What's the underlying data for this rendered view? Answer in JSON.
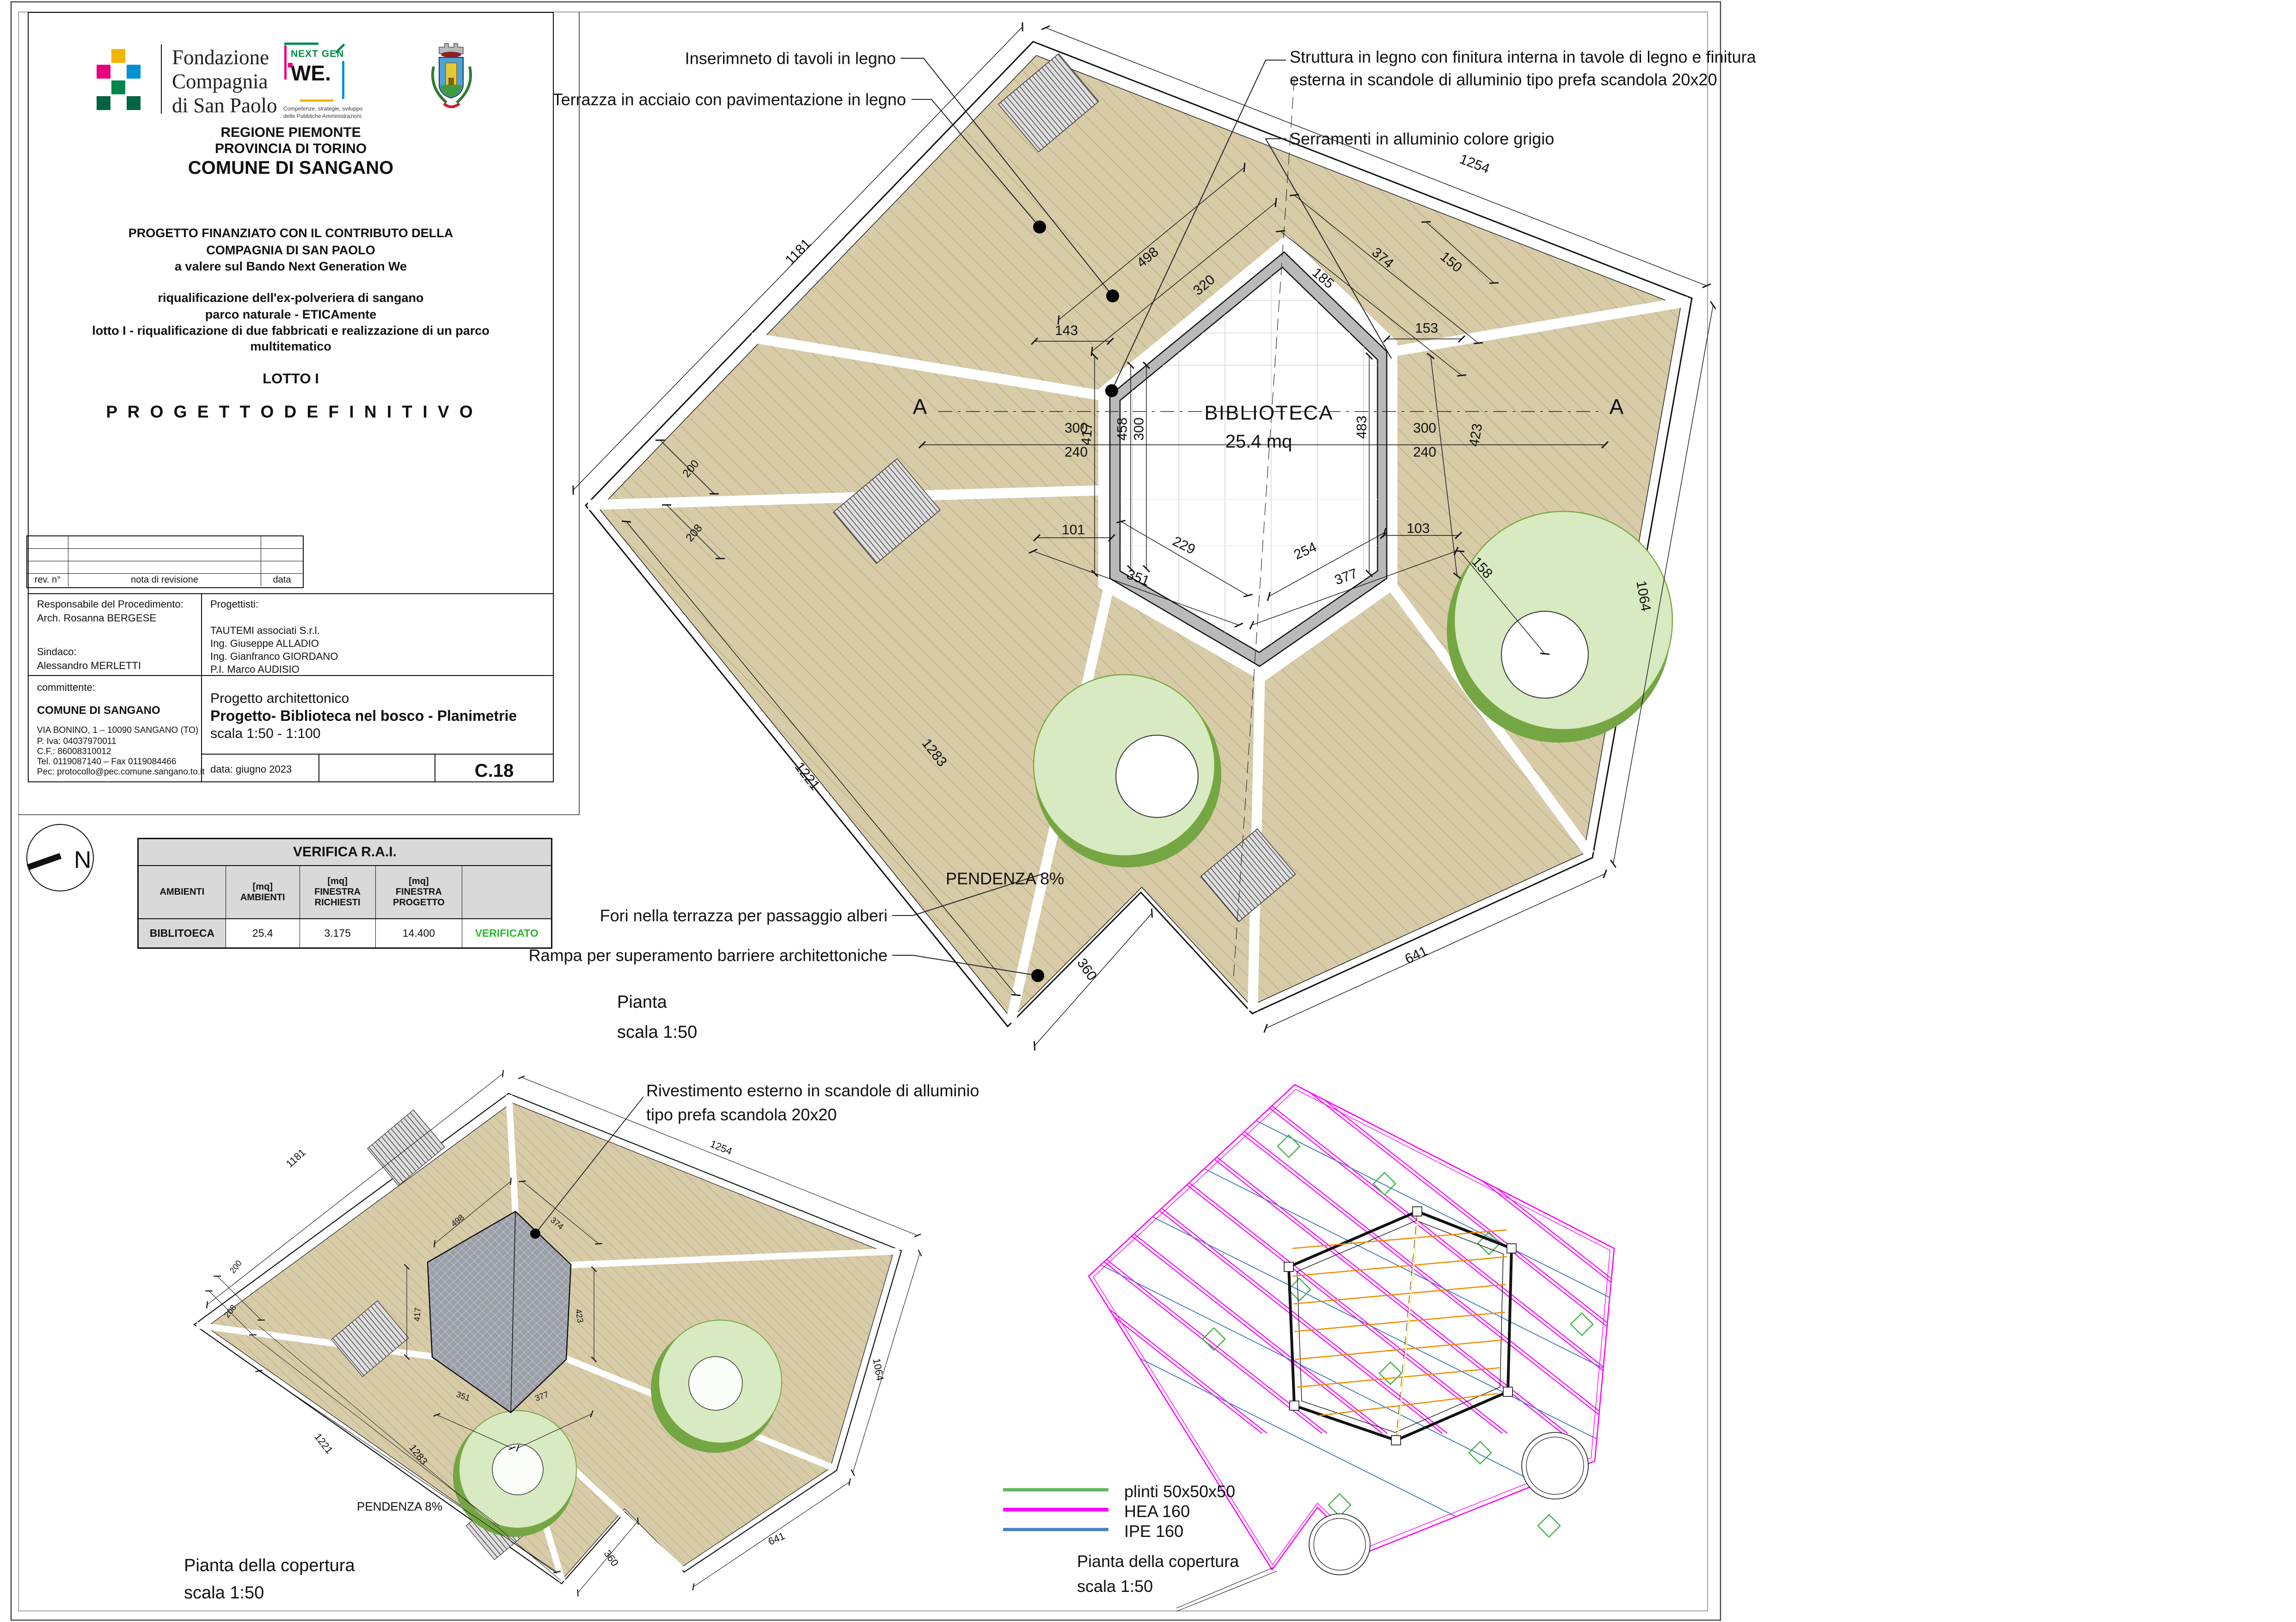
{
  "title_block": {
    "logos": {
      "fondazione": "Fondazione\nCompagnia\ndi San Paolo",
      "nextgen_top": "NEXT GEN",
      "nextgen_we": "WE.",
      "nextgen_caption": "Competenze, strategie, sviluppo\ndelle Pubbliche Amministrazioni."
    },
    "region": [
      "REGIONE PIEMONTE",
      "PROVINCIA DI TORINO",
      "COMUNE DI SANGANO"
    ],
    "funding": [
      "PROGETTO FINANZIATO CON IL CONTRIBUTO DELLA",
      "COMPAGNIA DI SAN PAOLO",
      "a valere sul Bando Next Generation We"
    ],
    "project": [
      "riqualificazione dell'ex-polveriera di sangano",
      "parco naturale - ETICAmente",
      "lotto I - riqualificazione di due fabbricati e realizzazione di un parco",
      "multitematico"
    ],
    "lotto": "LOTTO I",
    "fase": "P R O G E T T O   D E F I N I T I V O",
    "revision": {
      "col_rev": "rev. n°",
      "col_nota": "nota di revisione",
      "col_data": "data"
    },
    "responsabile": {
      "label": "Responsabile del Procedimento:",
      "name": "Arch. Rosanna BERGESE"
    },
    "sindaco": {
      "label": "Sindaco:",
      "name": "Alessandro MERLETTI"
    },
    "progettisti": {
      "label": "Progettisti:",
      "names": [
        "TAUTEMI associati S.r.l.",
        "Ing. Giuseppe ALLADIO",
        "Ing. Gianfranco GIORDANO",
        "P.I. Marco AUDISIO"
      ]
    },
    "committente": {
      "label": "committente:",
      "name": "COMUNE DI SANGANO",
      "address": "VIA BONINO, 1 – 10090 SANGANO (TO)",
      "piva": "P. Iva: 04037970011",
      "cf": "C.F.: 86008310012",
      "tel": "Tel. 0119087140 – Fax 0119084466",
      "pec": "Pec: protocollo@pec.comune.sangano.to.it"
    },
    "oggetto": {
      "line1": "Progetto architettonico",
      "line2": "Progetto- Biblioteca nel bosco - Planimetrie",
      "line3": "scala 1:50 - 1:100"
    },
    "data_label": "data: giugno 2023",
    "code": "C.18"
  },
  "verifica": {
    "title": "VERIFICA R.A.I.",
    "headers": [
      "AMBIENTI",
      "[mq]\nAMBIENTI",
      "[mq]\nFINESTRA\nRICHIESTI",
      "[mq]\nFINESTRA\nPROGETTO",
      ""
    ],
    "row": {
      "ambiente": "BIBLITOECA",
      "mq": "25.4",
      "richiesti": "3.175",
      "progetto": "14.400",
      "esito": "VERIFICATO"
    }
  },
  "north": {
    "label": "N"
  },
  "legend": {
    "items": [
      {
        "label": "plinti 50x50x50",
        "color": "#5cb85c"
      },
      {
        "label": "HEA 160",
        "color": "#ff00ff"
      },
      {
        "label": "IPE 160",
        "color": "#4a7ebb"
      }
    ]
  },
  "colors": {
    "deck": "#d7cba8",
    "deck_hatch": "#a6946e",
    "wall": "#b9b9b9",
    "roof": "#9b9fa7",
    "tree_light": "#d8eac1",
    "tree_dark": "#74a644",
    "hea": "#ff00ff",
    "ipe": "#4a7ebb",
    "plinto": "#3cb043",
    "verificato": "#2db82d",
    "orange_beam": "#f08c00"
  },
  "labels": [
    {
      "name": "ann-tavoli",
      "text": "Inserimneto di tavoli in legno"
    },
    {
      "name": "ann-terrazza",
      "text": "Terrazza in acciaio con pavimentazione in legno"
    },
    {
      "name": "ann-struttura",
      "text": "Struttura in legno con finitura interna in tavole di legno e finitura\nesterna in scandole di alluminio tipo prefa scandola 20x20"
    },
    {
      "name": "ann-serramenti",
      "text": "Serramenti in alluminio colore grigio"
    },
    {
      "name": "ann-fori",
      "text": "Fori nella terrazza per passaggio alberi"
    },
    {
      "name": "ann-rampa",
      "text": "Rampa per superamento barriere architettoniche"
    },
    {
      "name": "ann-rivestimento",
      "text": "Rivestimento esterno in scandole di alluminio\ntipo prefa scandola 20x20"
    },
    {
      "name": "plan-title-main",
      "text": "Pianta\nscala 1:50"
    },
    {
      "name": "plan-title-roof-left",
      "text": "Pianta della copertura\nscala 1:50"
    },
    {
      "name": "plan-title-roof-right",
      "text": "Pianta della copertura\nscala 1:50"
    },
    {
      "name": "room-label",
      "text": "BIBLIOTECA"
    },
    {
      "name": "room-area",
      "text": "25.4 mq"
    },
    {
      "name": "pendenza-main",
      "text": "PENDENZA 8%"
    },
    {
      "name": "pendenza-roof",
      "text": "PENDENZA 8%"
    },
    {
      "name": "section-a-left",
      "text": "A"
    },
    {
      "name": "section-a-right",
      "text": "A"
    },
    {
      "name": "dim-1181",
      "text": "1181"
    },
    {
      "name": "dim-1254",
      "text": "1254"
    },
    {
      "name": "dim-1064",
      "text": "1064"
    },
    {
      "name": "dim-641",
      "text": "641"
    },
    {
      "name": "dim-360",
      "text": "360"
    },
    {
      "name": "dim-1221",
      "text": "1221"
    },
    {
      "name": "dim-1283",
      "text": "1283"
    },
    {
      "name": "dim-200",
      "text": "200"
    },
    {
      "name": "dim-208",
      "text": "208"
    },
    {
      "name": "dim-498",
      "text": "498"
    },
    {
      "name": "dim-320",
      "text": "320"
    },
    {
      "name": "dim-185",
      "text": "185"
    },
    {
      "name": "dim-374",
      "text": "374"
    },
    {
      "name": "dim-150",
      "text": "150"
    },
    {
      "name": "dim-143",
      "text": "143"
    },
    {
      "name": "dim-153",
      "text": "153"
    },
    {
      "name": "dim-300L",
      "text": "300"
    },
    {
      "name": "dim-240L",
      "text": "240"
    },
    {
      "name": "dim-300R",
      "text": "300"
    },
    {
      "name": "dim-240R",
      "text": "240"
    },
    {
      "name": "dim-458",
      "text": "458"
    },
    {
      "name": "dim-300v",
      "text": "300"
    },
    {
      "name": "dim-483",
      "text": "483"
    },
    {
      "name": "dim-423",
      "text": "423"
    },
    {
      "name": "dim-417",
      "text": "417"
    },
    {
      "name": "dim-101",
      "text": "101"
    },
    {
      "name": "dim-103",
      "text": "103"
    },
    {
      "name": "dim-229",
      "text": "229"
    },
    {
      "name": "dim-254",
      "text": "254"
    },
    {
      "name": "dim-351",
      "text": "351"
    },
    {
      "name": "dim-377",
      "text": "377"
    },
    {
      "name": "dim-158",
      "text": "158"
    },
    {
      "name": "sdim-1181",
      "text": "1181"
    },
    {
      "name": "sdim-1254",
      "text": "1254"
    },
    {
      "name": "sdim-1064",
      "text": "1064"
    },
    {
      "name": "sdim-641",
      "text": "641"
    },
    {
      "name": "sdim-360",
      "text": "360"
    },
    {
      "name": "sdim-200",
      "text": "200"
    },
    {
      "name": "sdim-208",
      "text": "208"
    },
    {
      "name": "sdim-1221",
      "text": "1221"
    },
    {
      "name": "sdim-1283",
      "text": "1283"
    },
    {
      "name": "sdim-498",
      "text": "498"
    },
    {
      "name": "sdim-374",
      "text": "374"
    },
    {
      "name": "sdim-417",
      "text": "417"
    },
    {
      "name": "sdim-423",
      "text": "423"
    },
    {
      "name": "sdim-351",
      "text": "351"
    },
    {
      "name": "sdim-377",
      "text": "377"
    }
  ]
}
